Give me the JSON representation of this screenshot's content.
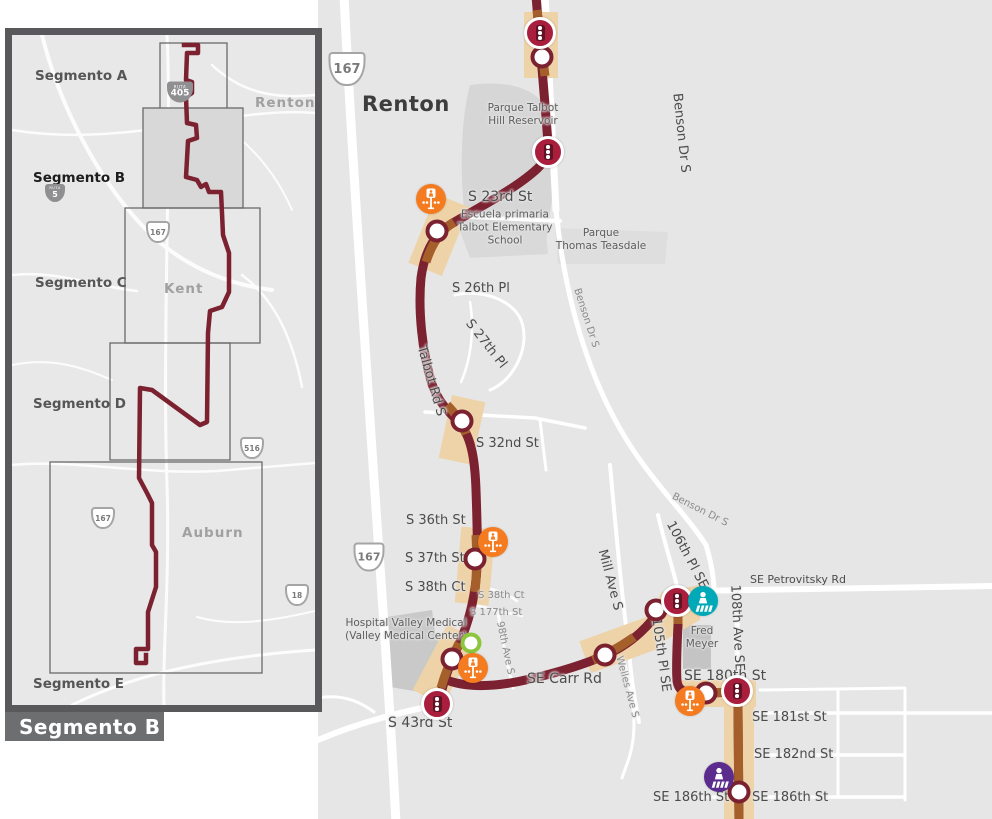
{
  "title": "Segmento B",
  "colors": {
    "map_bg": "#e6e6e6",
    "road": "#ffffff",
    "route": "#7b2130",
    "route_highlight": "#a55f2b",
    "improvement_band": "#eed3a8",
    "signal_red": "#a81e3c",
    "crossing_orange": "#f47b20",
    "crossing_teal": "#00a9b7",
    "crossing_purple": "#5b2b8d",
    "station_green": "#8cc63e",
    "inset_border": "#59595b",
    "title_bg": "#6d6e70"
  },
  "inset": {
    "segments": [
      "Segmento A",
      "Segmento B",
      "Segmento C",
      "Segmento D",
      "Segmento E"
    ],
    "cities": {
      "renton": "Renton",
      "kent": "Kent",
      "auburn": "Auburn"
    },
    "shields": {
      "ruta_label": "RUTA",
      "i405": "405",
      "i5": "5",
      "r167": "167",
      "r516": "516",
      "r18": "18"
    }
  },
  "map": {
    "city": "Renton",
    "shields": {
      "r167": "167"
    },
    "places": {
      "talbot_reservoir": "Parque Talbot\nHill Reservoir",
      "school": "Escuela primaria\nTalbot Elementary\nSchool",
      "teasdale": "Parque\nThomas Teasdale",
      "hospital": "Hospital Valley Medical\n(Valley Medical Center)",
      "fred_meyer": "Fred\nMeyer"
    },
    "streets": {
      "benson": "Benson Dr S",
      "s23": "S 23rd St",
      "s26": "S 26th Pl",
      "s27": "S 27th Pl",
      "talbot": "Talbot Rd S",
      "s32": "S 32nd St",
      "s36": "S 36th St",
      "s37": "S 37th St",
      "s38ct": "S 38th Ct",
      "s177": "S 177th St",
      "a98": "98th Ave S",
      "carr": "SE Carr Rd",
      "s43": "S 43rd St",
      "mill": "Mill Ave S",
      "wells": "Welles Ave S",
      "p105": "105th Pl SE",
      "p106": "106th Pl SE",
      "a108": "108th Ave SE",
      "petrovitsky": "SE Petrovitsky Rd",
      "se180": "SE 180th St",
      "se181": "SE 181st St",
      "se182": "SE 182nd St",
      "se186": "SE 186th St"
    }
  }
}
